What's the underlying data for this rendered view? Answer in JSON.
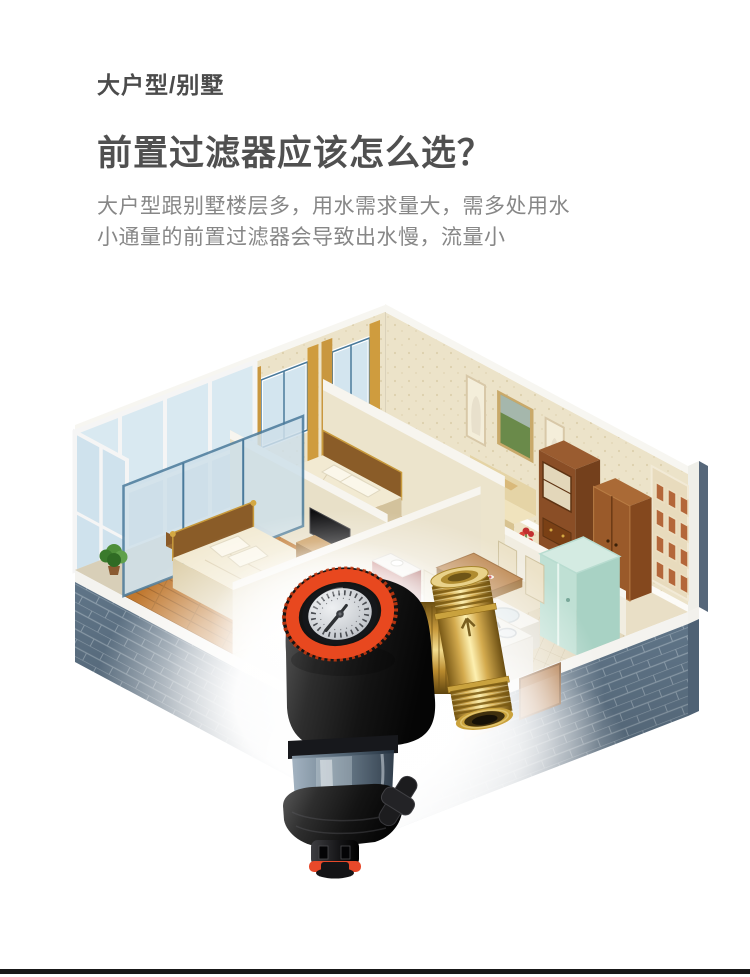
{
  "content": {
    "eyebrow": "大户型/别墅",
    "title": "前置过滤器应该怎么选？",
    "description": [
      "大户型跟别墅楼层多，用水需求量大，需多处用水",
      "小通量的前置过滤器会导致出水慢，流量小"
    ]
  },
  "illustration": {
    "label": "isometric-apartment-cutaway-with-prefilter-product",
    "colors": {
      "accent_orange": "#e8481f",
      "brass": "#d4ab4e",
      "brick_exterior": "#5f7487",
      "wallpaper": "#ece3c9",
      "wood_floor": "#c0782f",
      "glass": "#d9e9f1",
      "product_body": "#1a1a1a",
      "gauge_face": "#d5d8db"
    }
  },
  "footer": {
    "divider_color": "#191919"
  }
}
